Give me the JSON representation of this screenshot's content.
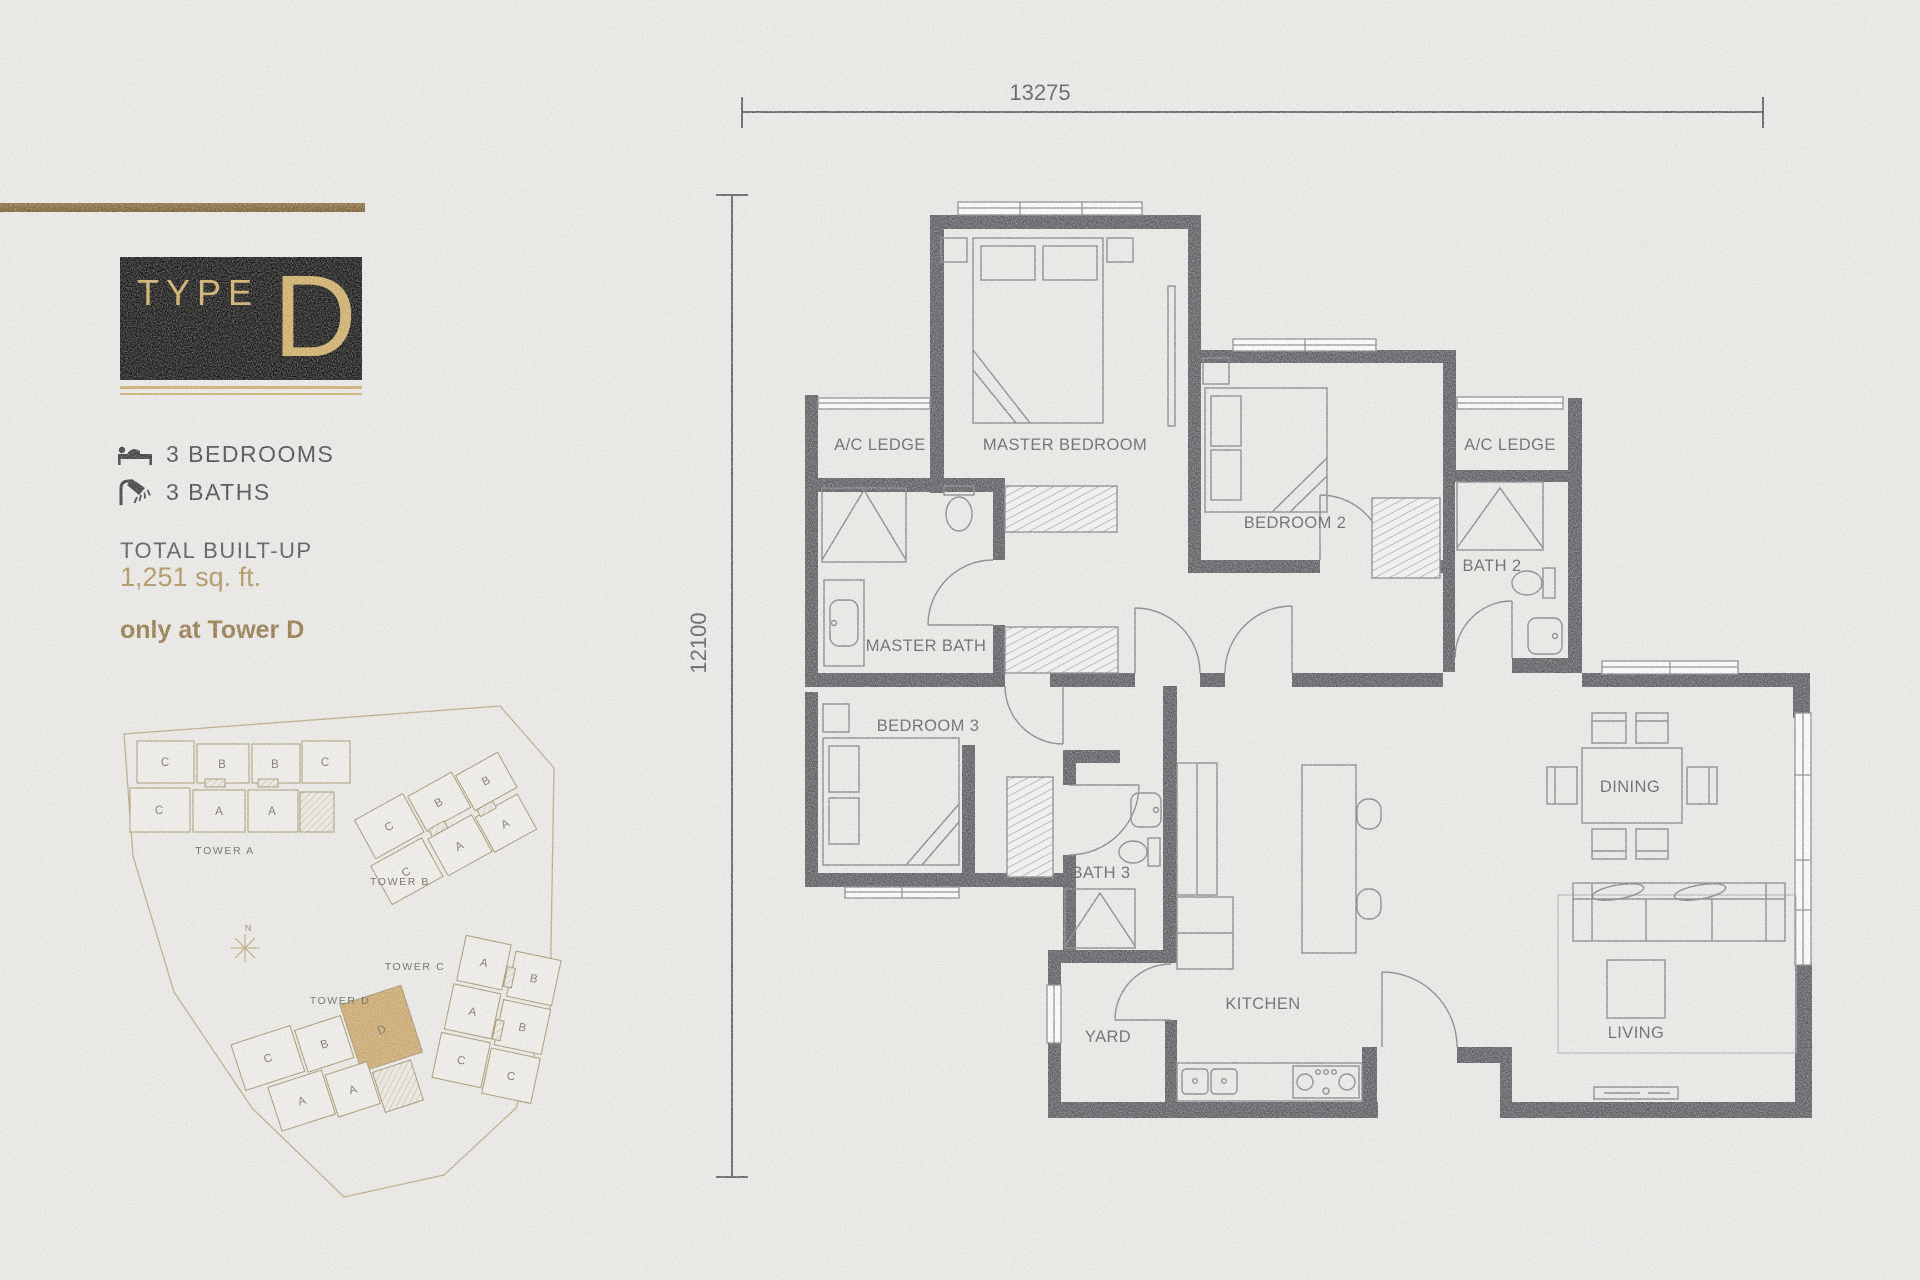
{
  "panel": {
    "badge": {
      "label": "TYPE",
      "letter": "D"
    },
    "features": [
      {
        "icon": "bed-icon",
        "label": "3 BEDROOMS"
      },
      {
        "icon": "shower-icon",
        "label": "3 BATHS"
      }
    ],
    "built_up_title": "TOTAL BUILT-UP",
    "built_up_value": "1,251 sq. ft.",
    "availability": "only at Tower D"
  },
  "floor_plan": {
    "dimensions": {
      "width": "13275",
      "height": "12100"
    },
    "rooms": {
      "ac_ledge_left": "A/C LEDGE",
      "master_bedroom": "MASTER BEDROOM",
      "bedroom2": "BEDROOM 2",
      "ac_ledge_right": "A/C LEDGE",
      "bath2": "BATH 2",
      "master_bath": "MASTER BATH",
      "bedroom3": "BEDROOM 3",
      "bath3": "BATH 3",
      "yard": "YARD",
      "kitchen": "KITCHEN",
      "dining": "DINING",
      "living": "LIVING"
    }
  },
  "site_plan": {
    "compass_label": "N",
    "highlighted_unit": "D",
    "towers": [
      {
        "name": "TOWER A",
        "letters": [
          "C",
          "B",
          "B",
          "C",
          "C",
          "A",
          "A"
        ]
      },
      {
        "name": "TOWER B",
        "letters": [
          "C",
          "B",
          "B",
          "C",
          "A",
          "A"
        ]
      },
      {
        "name": "TOWER C",
        "letters": [
          "A",
          "B",
          "A",
          "B",
          "C",
          "C"
        ]
      },
      {
        "name": "TOWER D",
        "letters": [
          "C",
          "B",
          "D",
          "A",
          "A"
        ]
      }
    ]
  },
  "colors": {
    "accent_gold": "#c8a25f",
    "value_gold": "#a8894f",
    "brown_text": "#8c6e3b",
    "wall_gray": "#54555a",
    "highlight_unit": "#c8a365"
  },
  "icons": {
    "features": [
      "bed-icon",
      "shower-icon"
    ],
    "compass": "compass-star-icon"
  }
}
